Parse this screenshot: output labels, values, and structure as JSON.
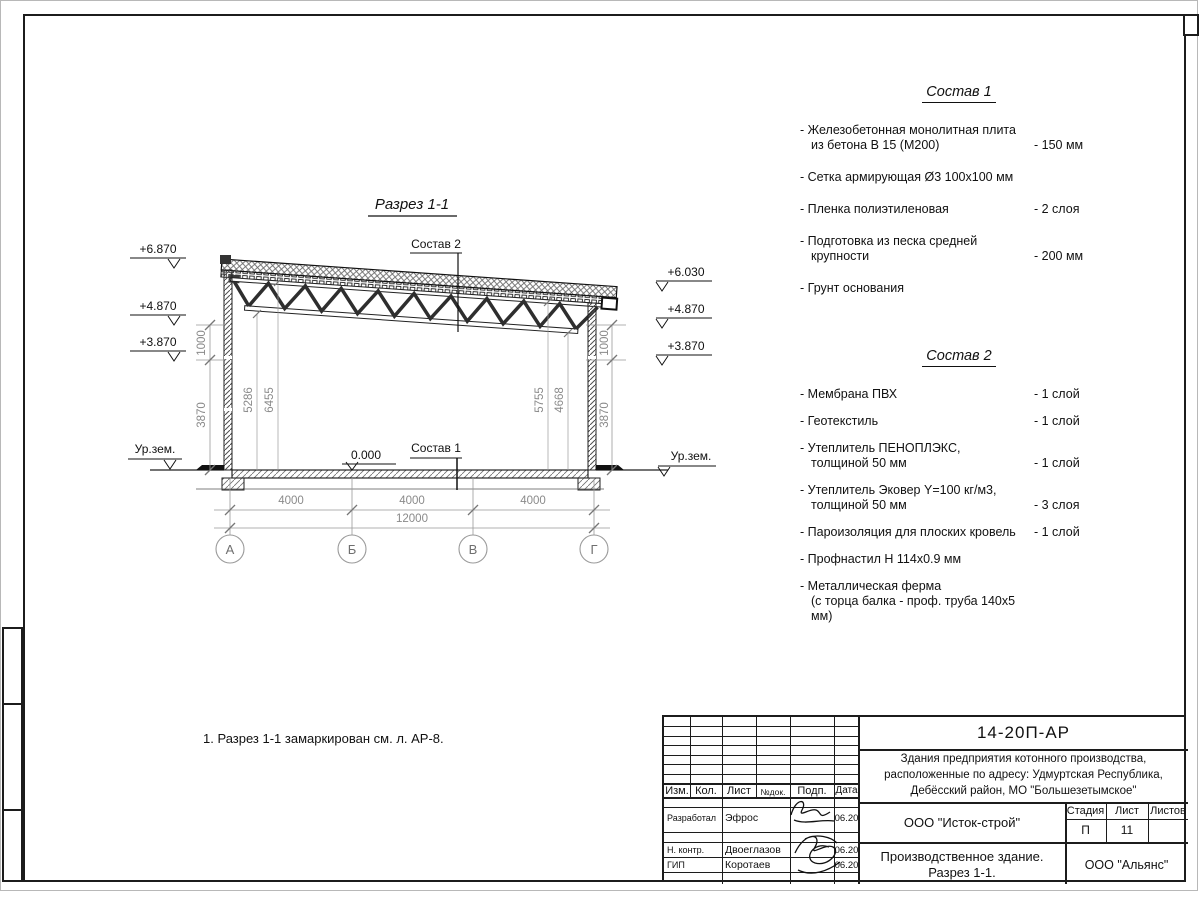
{
  "drawing": {
    "title": "Разрез 1-1",
    "sostav1_ref": "Состав 1",
    "sostav2_ref": "Состав 2",
    "zero_mark": "0.000",
    "ground_label_left": "Ур.зем.",
    "ground_label_right": "Ур.зем.",
    "elev": {
      "l1": "+6.870",
      "l2": "+4.870",
      "l3": "+3.870",
      "r1": "+6.030",
      "r2": "+4.870",
      "r3": "+3.870"
    },
    "vdim": {
      "left1": "1000",
      "left2": "3870",
      "right1": "1000",
      "right2": "3870",
      "in1": "5286",
      "in2": "6455",
      "in3": "5755",
      "in4": "4668"
    },
    "hdim": {
      "s1": "4000",
      "s2": "4000",
      "s3": "4000",
      "total": "12000"
    },
    "axes": [
      "А",
      "Б",
      "В",
      "Г"
    ]
  },
  "sostav1": {
    "title": "Состав 1",
    "items": [
      {
        "l1": "- Железобетонная  монолитная плита",
        "l2": "из бетона В 15 (М200)",
        "v": "- 150 мм"
      },
      {
        "l1": "- Сетка армирующая Ø3 100х100 мм",
        "l2": "",
        "v": ""
      },
      {
        "l1": "- Пленка полиэтиленовая",
        "l2": "",
        "v": "-  2 слоя"
      },
      {
        "l1": "- Подготовка из песка средней",
        "l2": "крупности",
        "v": "- 200 мм"
      },
      {
        "l1": "- Грунт основания",
        "l2": "",
        "v": ""
      }
    ]
  },
  "sostav2": {
    "title": "Состав 2",
    "items": [
      {
        "l1": "- Мембрана ПВХ",
        "l2": "",
        "v": "- 1 слой"
      },
      {
        "l1": "- Геотекстиль",
        "l2": "",
        "v": "- 1 слой"
      },
      {
        "l1": "- Утеплитель ПЕНОПЛЭКС,",
        "l2": "толщиной 50 мм",
        "v": "- 1 слой"
      },
      {
        "l1": "- Утеплитель Эковер Y=100 кг/м3,",
        "l2": "толщиной 50 мм",
        "v": "- 3 слоя"
      },
      {
        "l1": "- Пароизоляция для плоских кровель",
        "l2": "",
        "v": "- 1 слой"
      },
      {
        "l1": "- Профнастил Н 114х0.9 мм",
        "l2": "",
        "v": ""
      },
      {
        "l1": "- Металлическая ферма",
        "l2": "(с торца балка - проф. труба 140х5 мм)",
        "v": ""
      }
    ]
  },
  "note": "1. Разрез 1-1 замаркирован см. л. АР-8.",
  "titleblock": {
    "doc_number": "14-20П-АР",
    "project_line1": "Здания предприятия котонного производства,",
    "project_line2": "расположенные по адресу: Удмуртская Республика,",
    "project_line3": "Дебёсский район, МО \"Большезетымское\"",
    "org": "ООО \"Исток-строй\"",
    "object_line1": "Производственное здание.",
    "object_line2": "Разрез 1-1.",
    "contractor": "ООО \"Альянс\"",
    "headers": {
      "izm": "Изм.",
      "kol": "Кол.",
      "list": "Лист",
      "ndoc": "№док.",
      "podp": "Подп.",
      "data": "Дата",
      "stadia": "Стадия",
      "sheet": "Лист",
      "sheets": "Листов"
    },
    "stadia_value": "П",
    "sheet_value": "11",
    "sheets_value": "",
    "roles": [
      {
        "role": "Разработал",
        "name": "Эфрос",
        "date": "06.20"
      },
      {
        "role": "Н. контр.",
        "name": "Двоеглазов",
        "date": "06.20"
      },
      {
        "role": "ГИП",
        "name": "Коротаев",
        "date": "06.20"
      }
    ]
  }
}
